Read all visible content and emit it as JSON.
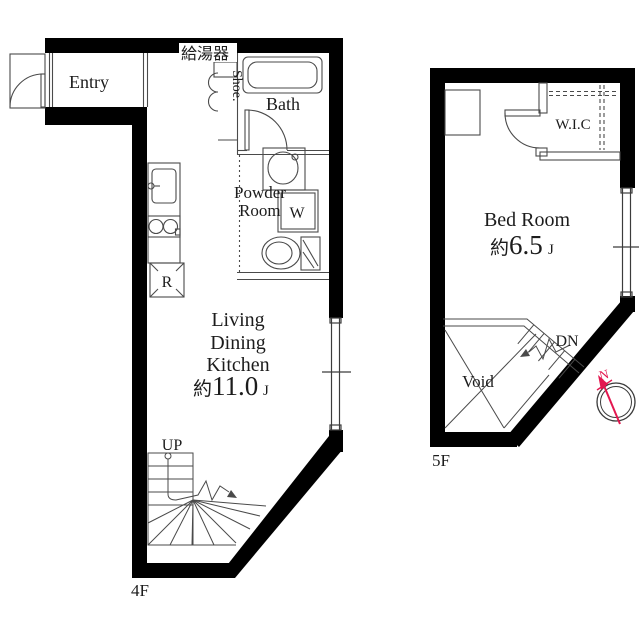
{
  "colors": {
    "wall": "#000000",
    "line": "#4a4a4a",
    "text": "#1c1c1c",
    "compass_needle": "#e3174f"
  },
  "floor4": {
    "label": "4F",
    "entry": "Entry",
    "water_heater": "給湯器",
    "shoe": "Shoe.",
    "bath": "Bath",
    "powder_line1": "Powder",
    "powder_line2": "Room",
    "washer": "W",
    "fridge": "R",
    "ldk_line1": "Living",
    "ldk_line2": "Dining",
    "ldk_line3": "Kitchen",
    "area_prefix": "約",
    "area_value": "11.0",
    "area_unit": "J",
    "stairs": "UP"
  },
  "floor5": {
    "label": "5F",
    "wic": "W.I.C",
    "bedroom": "Bed Room",
    "area_prefix": "約",
    "area_value": "6.5",
    "area_unit": "J",
    "void": "Void",
    "stairs": "DN",
    "compass_north": "N"
  }
}
